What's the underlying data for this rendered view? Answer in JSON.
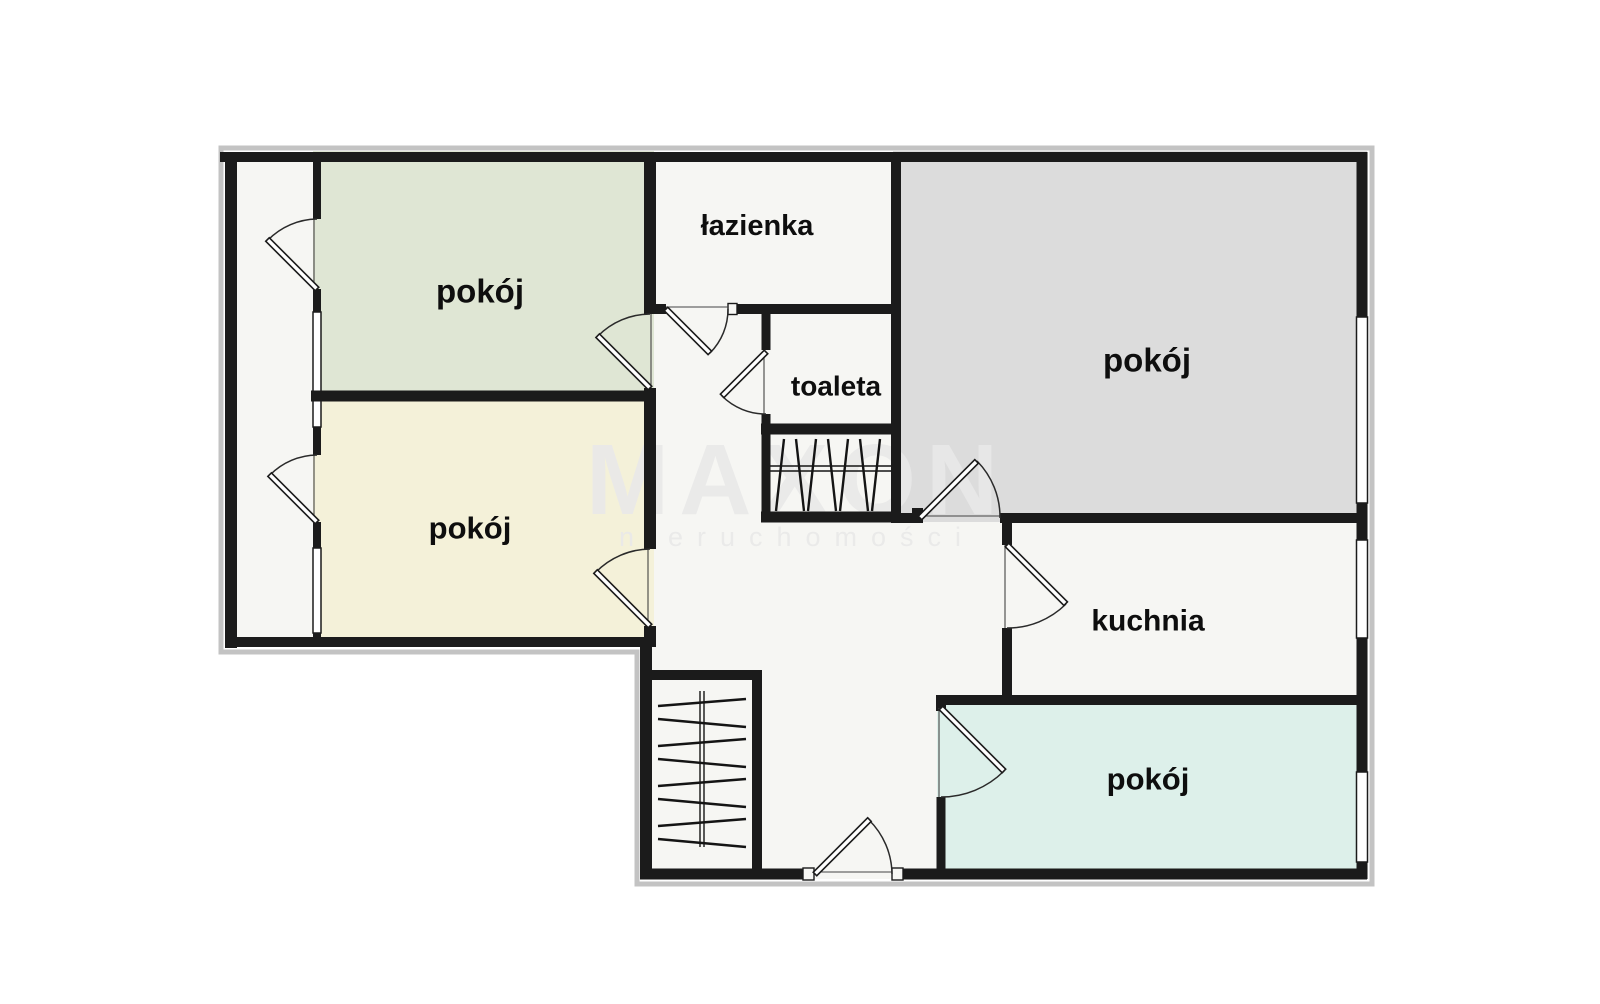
{
  "plan": {
    "watermark": {
      "line1": "MAXON",
      "line2": "nieruchomości"
    },
    "labels": {
      "room_top_left": "pokój",
      "room_mid_left": "pokój",
      "bathroom": "łazienka",
      "toilet": "toaleta",
      "room_top_right": "pokój",
      "kitchen": "kuchnia",
      "room_bottom_right": "pokój"
    },
    "colors": {
      "floor": "#f6f6f3",
      "room_top_left": "#dfe6d4",
      "room_mid_left": "#f4f1d9",
      "room_top_right": "#dcdcdc",
      "room_bottom_right": "#ddf0ea",
      "wall": "#1b1b1b",
      "outer_outline": "#c3c3c3",
      "watermark": "#e9e9e9"
    }
  }
}
